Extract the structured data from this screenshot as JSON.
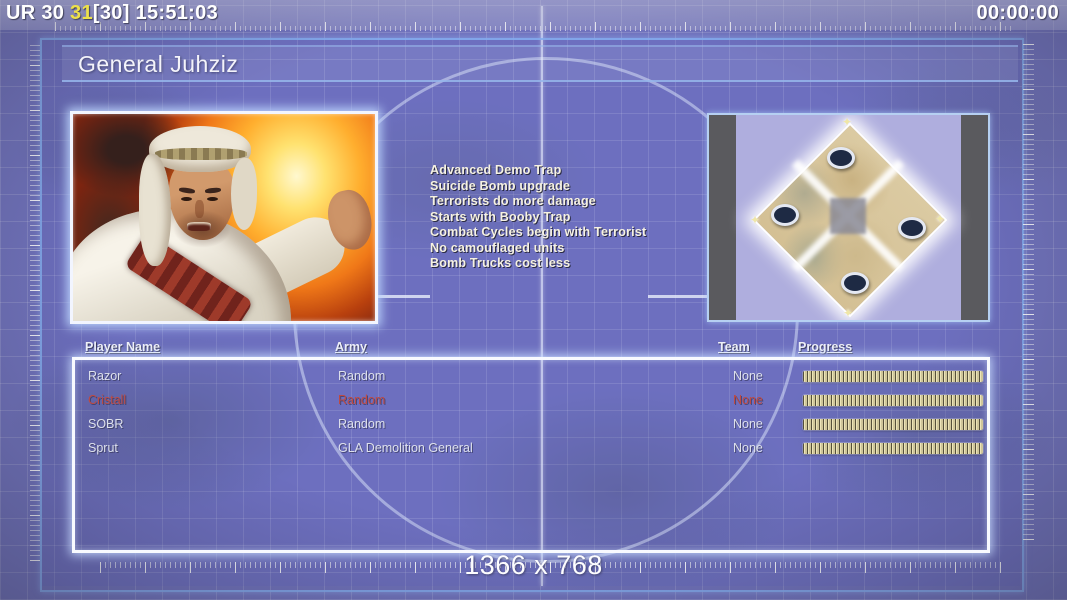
{
  "top_bar": {
    "map_code": "UR 30 ",
    "counter_yellow": "31",
    "counter_bracket": "[30] ",
    "clock": "15:51:03",
    "match_timer": "00:00:00"
  },
  "title": "General Juhziz",
  "general": {
    "perks": [
      "Advanced Demo Trap",
      "Suicide Bomb upgrade",
      "Terrorists do more damage",
      "Starts with Booby Trap",
      "Combat Cycles begin with Terrorist",
      "No camouflaged units",
      "Bomb Trucks cost less"
    ]
  },
  "minimap": {
    "start_position_count": 4,
    "corner_star_glyph": "✦"
  },
  "players": {
    "headers": {
      "name": "Player Name",
      "army": "Army",
      "team": "Team",
      "progress": "Progress"
    },
    "rows": [
      {
        "name": "Razor",
        "army": "Random",
        "team": "None",
        "progress_pct": 100,
        "color": "#dde0ec"
      },
      {
        "name": "Cristall",
        "army": "Random",
        "team": "None",
        "progress_pct": 100,
        "color": "#bf4a42"
      },
      {
        "name": "SOBR",
        "army": "Random",
        "team": "None",
        "progress_pct": 100,
        "color": "#dde0ec"
      },
      {
        "name": "Sprut",
        "army": "GLA Demolition General",
        "team": "None",
        "progress_pct": 100,
        "color": "#dde0ec"
      }
    ]
  },
  "footer": {
    "resolution_label": "1366 x 768"
  },
  "colors": {
    "accent_border_blue": "#84acee",
    "background_purple": "#7173bd",
    "counter_yellow": "#ede04a",
    "player_red": "#bf4a42",
    "player_normal": "#dde0ec",
    "progress_bar_tan": "#ddd5a8",
    "minimap_terrain_tan": "#d8c79d",
    "portrait_fire_orange": "#ffae2e"
  }
}
